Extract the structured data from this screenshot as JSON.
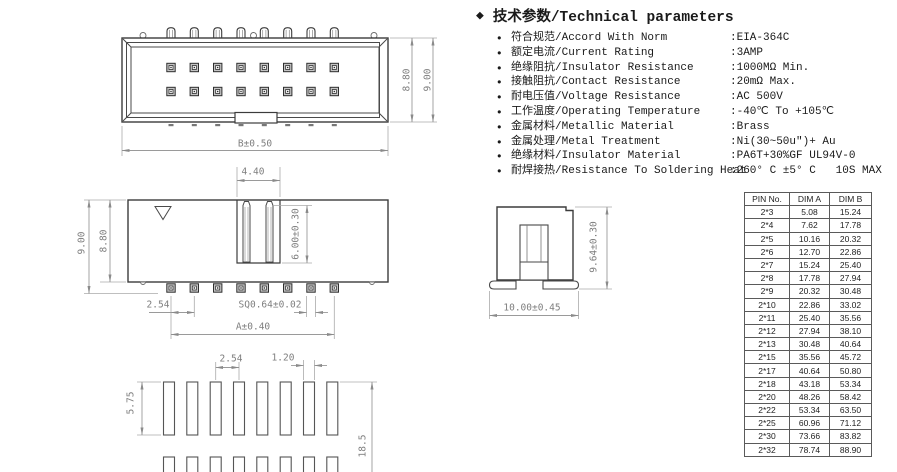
{
  "params": {
    "title_icon": "◆",
    "bullet": "●",
    "title": "技术参数/Technical parameters",
    "items": [
      {
        "label": "符合规范/Accord With Norm",
        "value": ":EIA-364C"
      },
      {
        "label": "额定电流/Current Rating",
        "value": ":3AMP"
      },
      {
        "label": "绝缘阻抗/Insulator Resistance",
        "value": ":1000MΩ Min."
      },
      {
        "label": "接触阻抗/Contact Resistance",
        "value": ":20mΩ Max."
      },
      {
        "label": "耐电压值/Voltage Resistance",
        "value": ":AC 500V"
      },
      {
        "label": "工作温度/Operating Temperature",
        "value": ":-40℃ To +105℃"
      },
      {
        "label": "金属材料/Metallic Material",
        "value": ":Brass"
      },
      {
        "label": "金属处理/Metal Treatment",
        "value": ":Ni(30~50u\")+ Au"
      },
      {
        "label": "绝缘材料/Insulator Material",
        "value": ":PA6T+30%GF UL94V-0"
      },
      {
        "label": "耐焊接热/Resistance To Soldering Heat",
        "value": ":260° C ±5° C   10S MAX"
      }
    ]
  },
  "dims": {
    "top_b": "B±0.50",
    "top_880": "8.80",
    "top_900": "9.00",
    "front_440": "4.40",
    "front_600": "6.00±0.30",
    "front_900": "9.00",
    "front_880": "8.80",
    "front_254": "2.54",
    "front_sq": "SQ0.64±0.02",
    "front_a": "A±0.40",
    "side_964": "9.64±0.30",
    "side_1000": "10.00±0.45",
    "fp_254": "2.54",
    "fp_120": "1.20",
    "fp_575": "5.75",
    "fp_185": "18.5"
  },
  "table": {
    "headers": [
      "PIN No.",
      "DIM A",
      "DIM B"
    ],
    "rows": [
      {
        "pin": "2*3",
        "a": "5.08",
        "b": "15.24"
      },
      {
        "pin": "2*4",
        "a": "7.62",
        "b": "17.78"
      },
      {
        "pin": "2*5",
        "a": "10.16",
        "b": "20.32"
      },
      {
        "pin": "2*6",
        "a": "12.70",
        "b": "22.86"
      },
      {
        "pin": "2*7",
        "a": "15.24",
        "b": "25.40"
      },
      {
        "pin": "2*8",
        "a": "17.78",
        "b": "27.94"
      },
      {
        "pin": "2*9",
        "a": "20.32",
        "b": "30.48"
      },
      {
        "pin": "2*10",
        "a": "22.86",
        "b": "33.02"
      },
      {
        "pin": "2*11",
        "a": "25.40",
        "b": "35.56"
      },
      {
        "pin": "2*12",
        "a": "27.94",
        "b": "38.10"
      },
      {
        "pin": "2*13",
        "a": "30.48",
        "b": "40.64"
      },
      {
        "pin": "2*15",
        "a": "35.56",
        "b": "45.72"
      },
      {
        "pin": "2*17",
        "a": "40.64",
        "b": "50.80"
      },
      {
        "pin": "2*18",
        "a": "43.18",
        "b": "53.34"
      },
      {
        "pin": "2*20",
        "a": "48.26",
        "b": "58.42"
      },
      {
        "pin": "2*22",
        "a": "53.34",
        "b": "63.50"
      },
      {
        "pin": "2*25",
        "a": "60.96",
        "b": "71.12"
      },
      {
        "pin": "2*30",
        "a": "73.66",
        "b": "83.82"
      },
      {
        "pin": "2*32",
        "a": "78.74",
        "b": "88.90"
      }
    ]
  }
}
